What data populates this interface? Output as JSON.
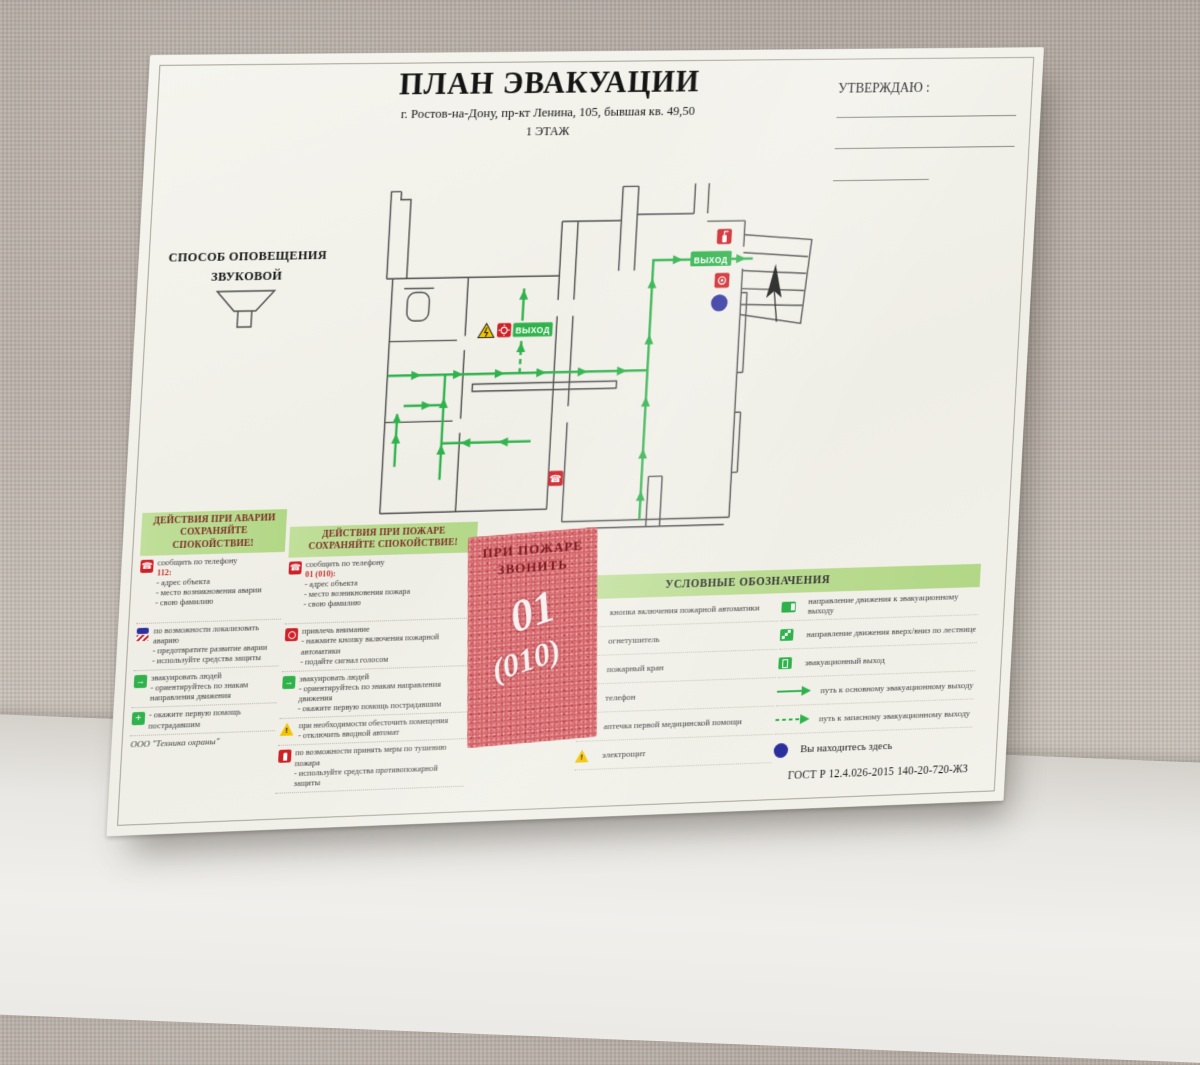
{
  "poster": {
    "title": "ПЛАН ЭВАКУАЦИИ",
    "subtitle": "г. Ростов-на-Дону, пр-кт  Ленина, 105, бывшая кв. 49,50",
    "floor": "1 ЭТАЖ",
    "approve_label": "УТВЕРЖДАЮ :",
    "notification": {
      "title": "СПОСОБ ОПОВЕЩЕНИЯ",
      "type": "ЗВУКОВОЙ"
    },
    "plan": {
      "exit_label": "ВЫХОД"
    },
    "emergency_column": {
      "title": "ДЕЙСТВИЯ ПРИ АВАРИИ",
      "subtitle": "СОХРАНЯЙТЕ СПОКОЙСТВИЕ!",
      "items": [
        {
          "icon": "phone-icon",
          "intro": "сообщить по телефону",
          "number": "112:",
          "details": "- адрес объекта\n- место возникновения аварии\n- свою фамилию"
        },
        {
          "icon": "hazard-icon",
          "details": "по возможности локализовать аварию\n- предотвратите развитие аварии\n- используйте средства защиты"
        },
        {
          "icon": "evacuation-icon",
          "details": "эвакуировать людей\n- ориентируйтесь по знакам направления движения"
        },
        {
          "icon": "first-aid-icon",
          "details": "- окажите первую помощь пострадавшим"
        }
      ],
      "footer": "ООО \"Техника охраны\""
    },
    "fire_column": {
      "title": "ДЕЙСТВИЯ ПРИ ПОЖАРЕ",
      "subtitle": "СОХРАНЯЙТЕ СПОКОЙСТВИЕ!",
      "items": [
        {
          "icon": "phone-icon",
          "intro": "сообщить по телефону",
          "number": "01 (010):",
          "details": "- адрес объекта\n- место возникновения пожара\n- свою фамилию"
        },
        {
          "icon": "call-point-icon",
          "details": "привлечь внимание\n- нажмите кнопку включения пожарной автоматики\n- подайте сигнал голосом"
        },
        {
          "icon": "evacuation-icon",
          "details": "эвакуировать людей\n- ориентируйтесь по знакам направления движения\n- окажите первую помощь пострадавшим"
        },
        {
          "icon": "electric-warning-icon",
          "details": "при необходимости обесточить помещения\n- отключить вводной автомат"
        },
        {
          "icon": "extinguisher-icon",
          "details": "по возможности принять меры по тушению пожара\n- используйте средства противопожарной защиты"
        }
      ]
    },
    "stamp": {
      "line1": "ПРИ ПОЖАРЕ",
      "line2": "ЗВОНИТЬ",
      "big": "01",
      "big2": "(010)"
    },
    "legend": {
      "title": "УСЛОВНЫЕ ОБОЗНАЧЕНИЯ",
      "left": [
        {
          "icon": "fire-automation-button-icon",
          "label": "кнопка включения пожарной автоматики"
        },
        {
          "icon": "extinguisher-icon",
          "label": "огнетушитель"
        },
        {
          "icon": "fire-hydrant-icon",
          "label": "пожарный кран"
        },
        {
          "icon": "phone-icon",
          "label": "телефон"
        },
        {
          "icon": "first-aid-kit-icon",
          "label": "аптечка первой медицинской помощи"
        },
        {
          "icon": "electric-panel-icon",
          "label": "электрощит"
        }
      ],
      "right": [
        {
          "icon": "direction-to-exit-icon",
          "label": "направление движения к эвакуационному выходу"
        },
        {
          "icon": "stairs-direction-icon",
          "label": "направление движения вверх/вниз по лестнице"
        },
        {
          "icon": "evacuation-exit-icon",
          "label": "эвакуационный выход"
        },
        {
          "icon": "main-route-arrow-icon",
          "label": "путь к основному эвакуационному выходу"
        },
        {
          "icon": "reserve-route-arrow-icon",
          "label": "путь к запасному эвакуационному выходу"
        },
        {
          "icon": "you-are-here-dot",
          "label": "Вы находитесь здесь"
        }
      ],
      "gost": "ГОСТ Р 12.4.026-2015  140-20-720-ЖЗ"
    },
    "colors": {
      "route_green": "#2fb24c",
      "band_green": "#b7d98b",
      "sign_red": "#cd2027",
      "you_are_here_blue": "#2b2e9d",
      "stamp_red": "#d05459"
    }
  }
}
